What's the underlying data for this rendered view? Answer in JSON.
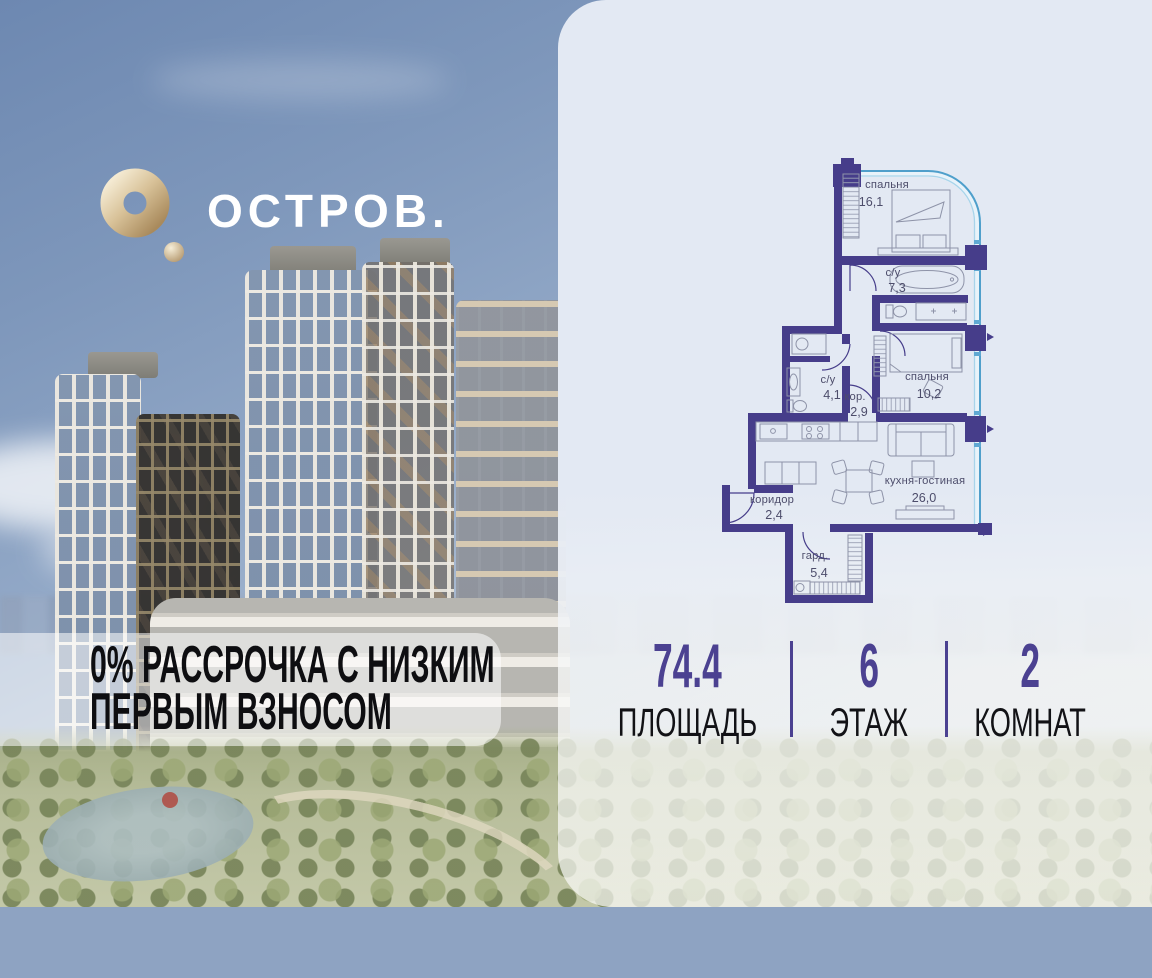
{
  "brand": {
    "name": "ОСТРОВ.",
    "logo_icon": "gold-torus-with-dot"
  },
  "promo": {
    "line1": "0% РАССРОЧКА С НИЗКИМ",
    "line2": "ПЕРВЫМ ВЗНОСОМ"
  },
  "floorplan": {
    "type": "apartment-plan",
    "rooms": [
      {
        "name": "спальня",
        "area": "16,1"
      },
      {
        "name": "с/у",
        "area": "7,3"
      },
      {
        "name": "с/у",
        "area": "4,1"
      },
      {
        "name": "кор.",
        "area": "2,9"
      },
      {
        "name": "спальня",
        "area": "10,2"
      },
      {
        "name": "кухня-гостиная",
        "area": "26,0"
      },
      {
        "name": "коридор",
        "area": "2,4"
      },
      {
        "name": "гард.",
        "area": "5,4"
      }
    ]
  },
  "stats": [
    {
      "value": "74.4",
      "label": "ПЛОЩАДЬ"
    },
    {
      "value": "6",
      "label": "ЭТАЖ"
    },
    {
      "value": "2",
      "label": "КОМНАТ"
    }
  ],
  "colors": {
    "accent_purple": "#4b4191",
    "wall_purple": "#463d8a",
    "window_blue": "#5fa8d2",
    "logo_gold": "#c8a876",
    "panel_background": "#e3e9f3"
  }
}
